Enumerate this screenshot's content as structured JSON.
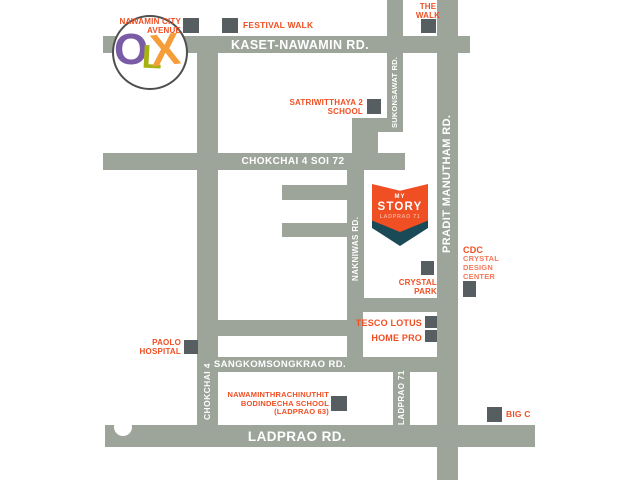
{
  "map_title": "My Story Ladprao 71 location map",
  "roads": {
    "kaset_nawamin": "KASET-NAWAMIN RD.",
    "chokchai4_soi72": "CHOKCHAI 4 SOI 72",
    "sangkomsongkrao": "SANGKOMSONGKRAO RD.",
    "ladprao": "LADPRAO RD.",
    "pradit_manutham": "PRADIT MANUTHAM RD.",
    "sukonsawat": "SUKONSAWAT RD.",
    "nakniwas": "NAKNIWAS RD.",
    "chokchai4": "CHOKCHAI 4",
    "ladprao71": "LADPRAO 71"
  },
  "landmarks": {
    "nawamin_city_avenue": {
      "line1": "NAWAMIN CITY",
      "line2": "AVENUE"
    },
    "festival_walk": {
      "label": "FESTIVAL WALK"
    },
    "the_walk": {
      "line1": "THE",
      "line2": "WALK"
    },
    "satriwitthaya2_school": {
      "line1": "SATRIWITTHAYA 2",
      "line2": "SCHOOL"
    },
    "crystal_park": {
      "line1": "CRYSTAL",
      "line2": "PARK"
    },
    "cdc": {
      "line1": "CDC",
      "line2": "CRYSTAL",
      "line3": "DESIGN",
      "line4": "CENTER"
    },
    "tesco_lotus": {
      "label": "TESCO LOTUS"
    },
    "home_pro": {
      "label": "HOME PRO"
    },
    "paolo_hospital": {
      "line1": "PAOLO",
      "line2": "HOSPITAL"
    },
    "bodindecha_school": {
      "line1": "NAWAMINTHRACHINUTHIT",
      "line2": "BODINDECHA SCHOOL",
      "line3": "(LADPRAO 63)"
    },
    "big_c": {
      "label": "BIG C"
    }
  },
  "project_logo": {
    "line1": "MY",
    "line2": "STORY",
    "line3": "LADPRAO 71"
  },
  "watermark": {
    "o": "O",
    "l": "L",
    "x": "X"
  },
  "colors": {
    "road_gray": "#9da59b",
    "marker_gray": "#575e62",
    "accent_orange": "#f04f23",
    "accent_orange_light": "#f4795c",
    "logo_orange": "#f04e23",
    "logo_teal": "#1b4a57",
    "olx_purple": "#7a5ca6",
    "olx_green": "#a6b212",
    "olx_orange": "#f59d38"
  }
}
